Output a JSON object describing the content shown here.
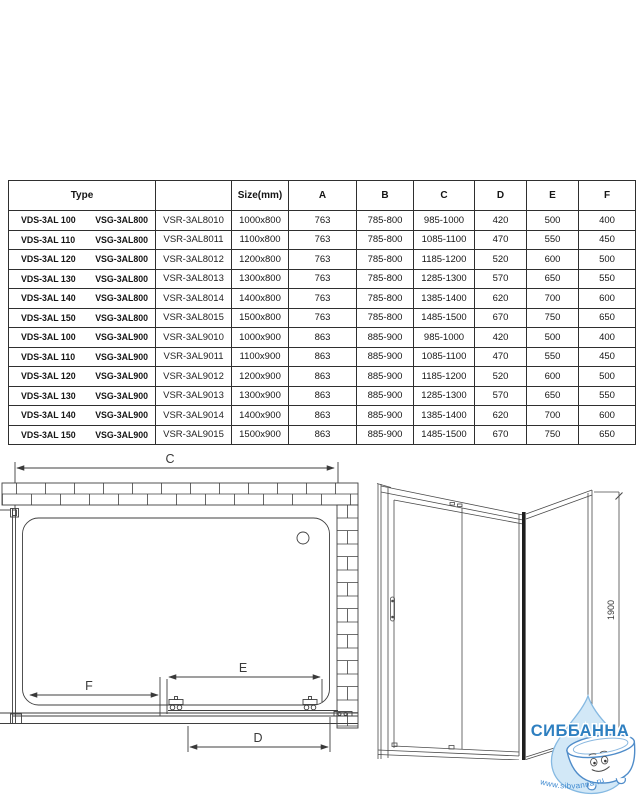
{
  "table": {
    "headers": {
      "type": "Type",
      "code": "",
      "size": "Size(mm)",
      "a": "A",
      "b": "B",
      "c": "C",
      "d": "D",
      "e": "E",
      "f": "F"
    },
    "rows": [
      {
        "t1": "VDS-3AL 100",
        "t2": "VSG-3AL800",
        "code": "VSR-3AL8010",
        "size": "1000x800",
        "a": "763",
        "b": "785-800",
        "c": "985-1000",
        "d": "420",
        "e": "500",
        "f": "400"
      },
      {
        "t1": "VDS-3AL 110",
        "t2": "VSG-3AL800",
        "code": "VSR-3AL8011",
        "size": "1100x800",
        "a": "763",
        "b": "785-800",
        "c": "1085-1100",
        "d": "470",
        "e": "550",
        "f": "450"
      },
      {
        "t1": "VDS-3AL 120",
        "t2": "VSG-3AL800",
        "code": "VSR-3AL8012",
        "size": "1200x800",
        "a": "763",
        "b": "785-800",
        "c": "1185-1200",
        "d": "520",
        "e": "600",
        "f": "500"
      },
      {
        "t1": "VDS-3AL 130",
        "t2": "VSG-3AL800",
        "code": "VSR-3AL8013",
        "size": "1300x800",
        "a": "763",
        "b": "785-800",
        "c": "1285-1300",
        "d": "570",
        "e": "650",
        "f": "550"
      },
      {
        "t1": "VDS-3AL 140",
        "t2": "VSG-3AL800",
        "code": "VSR-3AL8014",
        "size": "1400x800",
        "a": "763",
        "b": "785-800",
        "c": "1385-1400",
        "d": "620",
        "e": "700",
        "f": "600"
      },
      {
        "t1": "VDS-3AL 150",
        "t2": "VSG-3AL800",
        "code": "VSR-3AL8015",
        "size": "1500x800",
        "a": "763",
        "b": "785-800",
        "c": "1485-1500",
        "d": "670",
        "e": "750",
        "f": "650"
      },
      {
        "t1": "VDS-3AL 100",
        "t2": "VSG-3AL900",
        "code": "VSR-3AL9010",
        "size": "1000x900",
        "a": "863",
        "b": "885-900",
        "c": "985-1000",
        "d": "420",
        "e": "500",
        "f": "400"
      },
      {
        "t1": "VDS-3AL 110",
        "t2": "VSG-3AL900",
        "code": "VSR-3AL9011",
        "size": "1100x900",
        "a": "863",
        "b": "885-900",
        "c": "1085-1100",
        "d": "470",
        "e": "550",
        "f": "450"
      },
      {
        "t1": "VDS-3AL 120",
        "t2": "VSG-3AL900",
        "code": "VSR-3AL9012",
        "size": "1200x900",
        "a": "863",
        "b": "885-900",
        "c": "1185-1200",
        "d": "520",
        "e": "600",
        "f": "500"
      },
      {
        "t1": "VDS-3AL 130",
        "t2": "VSG-3AL900",
        "code": "VSR-3AL9013",
        "size": "1300x900",
        "a": "863",
        "b": "885-900",
        "c": "1285-1300",
        "d": "570",
        "e": "650",
        "f": "550"
      },
      {
        "t1": "VDS-3AL 140",
        "t2": "VSG-3AL900",
        "code": "VSR-3AL9014",
        "size": "1400x900",
        "a": "863",
        "b": "885-900",
        "c": "1385-1400",
        "d": "620",
        "e": "700",
        "f": "600"
      },
      {
        "t1": "VDS-3AL 150",
        "t2": "VSG-3AL900",
        "code": "VSR-3AL9015",
        "size": "1500x900",
        "a": "863",
        "b": "885-900",
        "c": "1485-1500",
        "d": "670",
        "e": "750",
        "f": "650"
      }
    ]
  },
  "drawing_left": {
    "dim_c": "C",
    "dim_f": "F",
    "dim_e": "E",
    "dim_d": "D"
  },
  "drawing_right": {
    "dim_height": "1900"
  },
  "watermark": {
    "brand": "СИББАННА",
    "url": "www.sibvanna.ru",
    "brand_color": "#2e7fc0",
    "url_color": "#3f8ad0",
    "drop_fill": "#d2e8f7",
    "drop_stroke": "#85b9e2"
  },
  "line_color": "#3f3f3f"
}
